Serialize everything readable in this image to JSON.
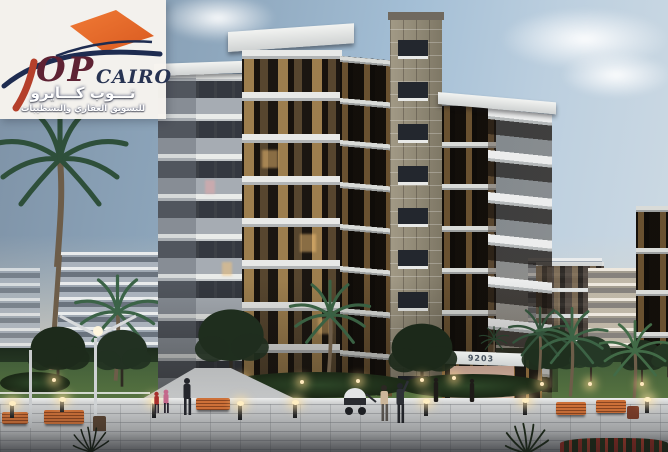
{
  "brand": {
    "name": "TOP CAIRO",
    "latin_op": "OP",
    "latin_cairo": "CAIRO",
    "arabic_name": "تـــوب كـــايرو",
    "arabic_tagline": "للتسويق العقاري والتشطيبات"
  },
  "building": {
    "unit_number": "9203"
  },
  "colors": {
    "logo_orange": "#e8672e",
    "logo_navy": "#1e2c50",
    "logo_maroon": "#5e2233",
    "logo_red": "#b5402b",
    "sky_top": "#7e92a6",
    "sky_horizon": "#ddd5c3",
    "facade_dark": "#30281f",
    "balcony_white": "#e8e9e7",
    "stone_gray": "#99917e",
    "window_warm": "#eeb96e",
    "lawn_green": "#4e6b3c",
    "bench_orange": "#c2682f"
  }
}
